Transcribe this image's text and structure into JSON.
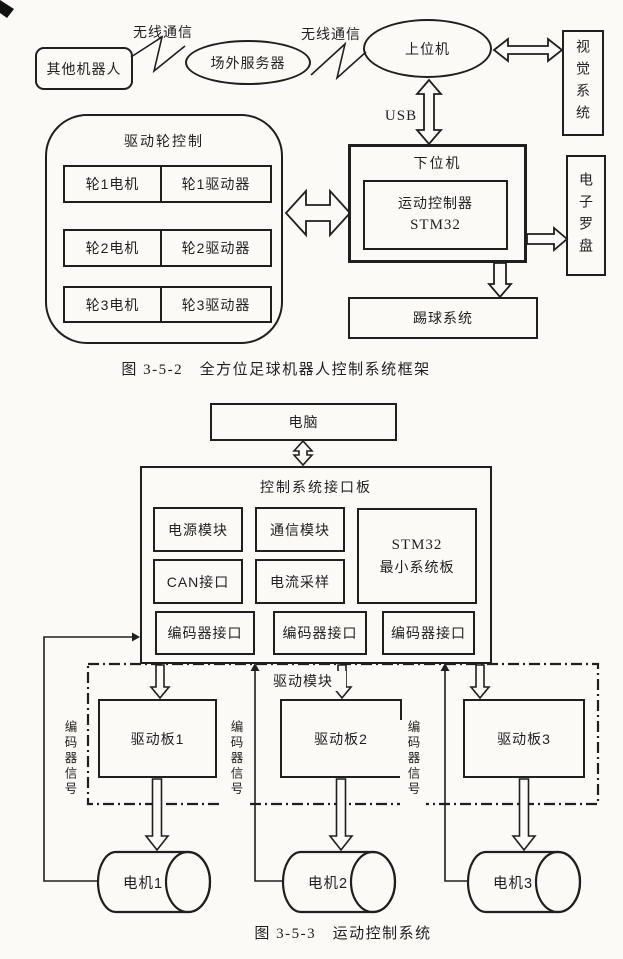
{
  "figure1": {
    "caption": "图 3-5-2　全方位足球机器人控制系统框架",
    "wireless_label_1": "无线通信",
    "wireless_label_2": "无线通信",
    "other_robots": "其他机器人",
    "offsite_server": "场外服务器",
    "host_computer": "上位机",
    "vision_system": "视觉系统",
    "usb_label": "USB",
    "lower_computer": "下位机",
    "motion_controller": {
      "line1": "运动控制器",
      "line2": "STM32"
    },
    "electronic_compass": "电子罗盘",
    "kicking_system": "踢球系统",
    "drive_wheel_control": "驱动轮控制",
    "wheel_rows": [
      {
        "motor": "轮1电机",
        "driver": "轮1驱动器"
      },
      {
        "motor": "轮2电机",
        "driver": "轮2驱动器"
      },
      {
        "motor": "轮3电机",
        "driver": "轮3驱动器"
      }
    ]
  },
  "figure2": {
    "caption": "图 3-5-3　运动控制系统",
    "computer": "电脑",
    "interface_board": "控制系统接口板",
    "power_module": "电源模块",
    "comm_module": "通信模块",
    "stm32_board": {
      "line1": "STM32",
      "line2": "最小系统板"
    },
    "can_interface": "CAN接口",
    "current_sampling": "电流采样",
    "encoder_interfaces": [
      "编码器接口",
      "编码器接口",
      "编码器接口"
    ],
    "drive_module": "驱动模块",
    "drive_boards": [
      "驱动板1",
      "驱动板2",
      "驱动板3"
    ],
    "encoder_signal_labels": [
      "编码器信号",
      "编码器信号",
      "编码器信号"
    ],
    "motors": [
      "电机1",
      "电机2",
      "电机3"
    ]
  }
}
